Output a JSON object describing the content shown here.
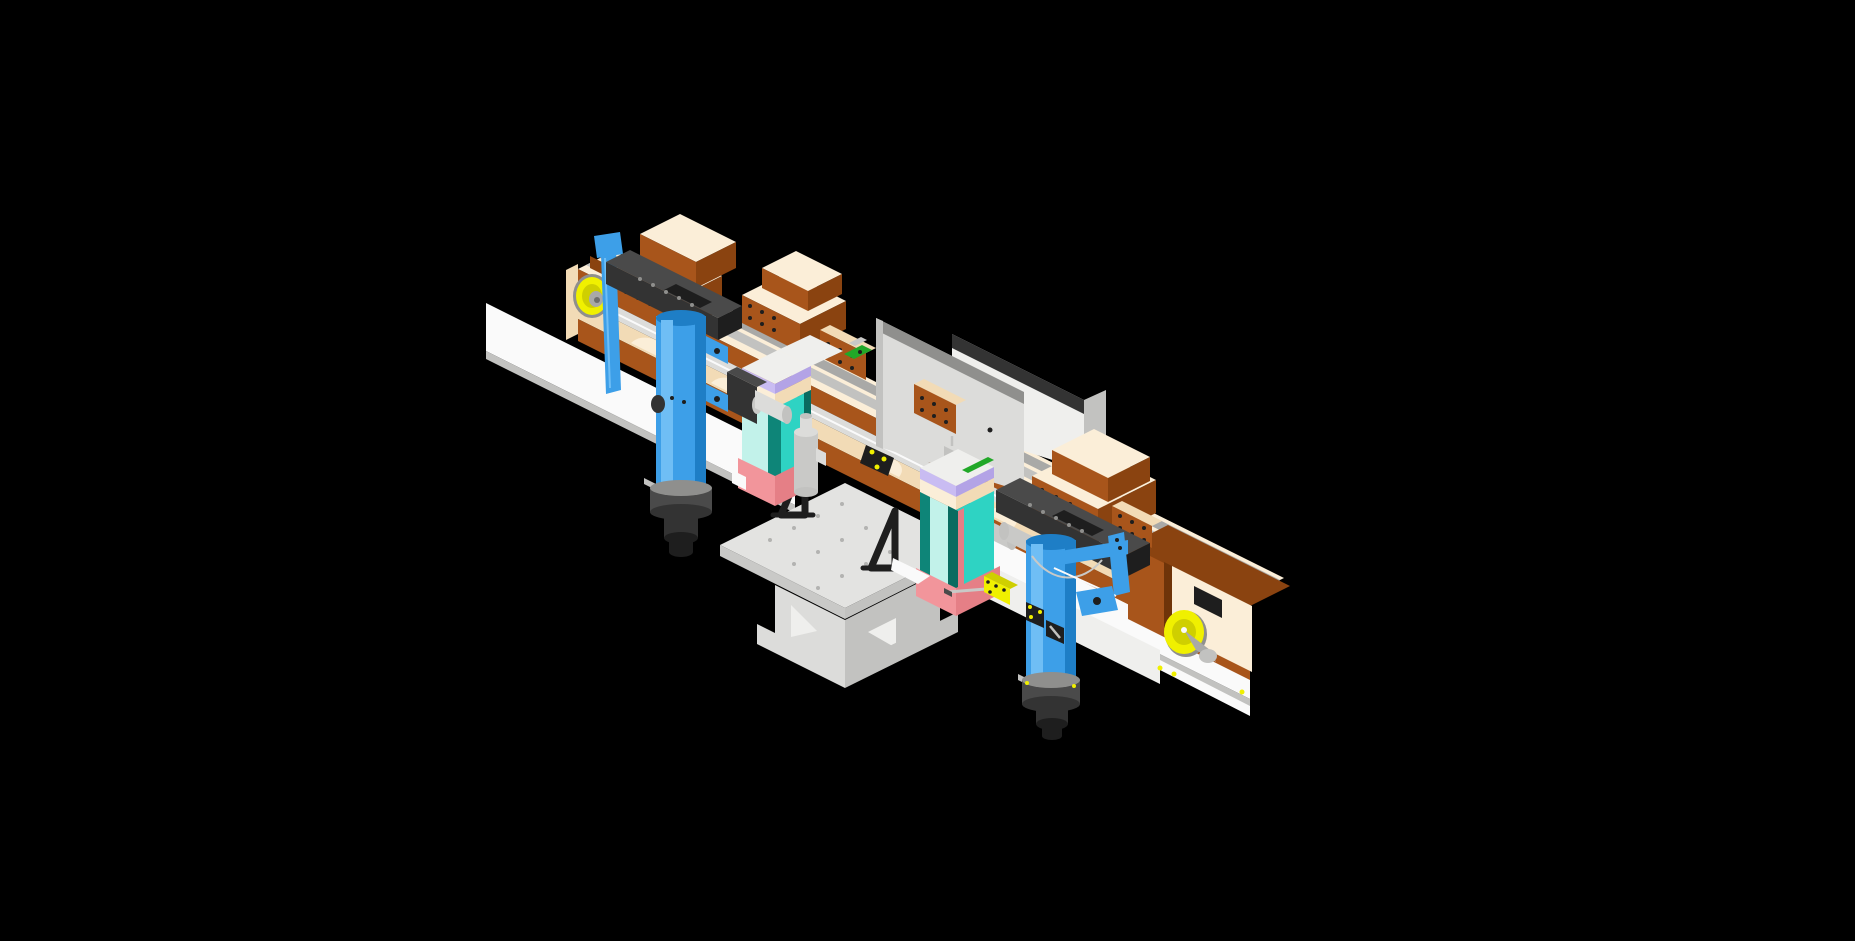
{
  "meta": {
    "description": "Isometric 3D CAD render of an automated dual-conveyor assembly machine floating on a black viewport background",
    "view": "isometric",
    "background": "#000000"
  },
  "colors": {
    "background": "#000000",
    "brown": "#A8551B",
    "brownDark": "#8A4310",
    "brownDarker": "#6F3409",
    "creamTop": "#FBEED8",
    "creamSide": "#F2DBB6",
    "creamDark": "#E6C99E",
    "white": "#FAFAFA",
    "whiteDim": "#EFEFED",
    "grayLight": "#DCDCDA",
    "gray": "#C2C2C0",
    "grayMid": "#A9A9A7",
    "grayDark": "#6E6E6C",
    "steel": "#8F8F8D",
    "silver": "#C9C9C7",
    "slate": "#4A4A4A",
    "slateDark": "#333333",
    "nearBlack": "#1E1E1E",
    "blue": "#3D9FE8",
    "blueLight": "#6FBEF5",
    "blueDark": "#1E7EC6",
    "teal": "#2ED3C3",
    "tealPale": "#C2F2EA",
    "tealDark": "#0E8578",
    "tealDeep": "#0A6B60",
    "pink": "#F2959B",
    "pinkDark": "#E57F86",
    "lavender": "#C9BCF2",
    "lavenderDark": "#B3A3E6",
    "yellow": "#F0F000",
    "yellowDark": "#CFCF00",
    "green": "#21A828",
    "tableTop": "#E3E3E1",
    "tableSide": "#C9C9C7",
    "tableDark": "#B3B3B1"
  },
  "parts": [
    {
      "name": "left-conveyor",
      "label": "Left conveyor rail module",
      "color_key": "brown"
    },
    {
      "name": "right-conveyor",
      "label": "Right conveyor rail module",
      "color_key": "brown"
    },
    {
      "name": "left-idler-pulley",
      "label": "Left yellow idler pulley",
      "color_key": "yellow"
    },
    {
      "name": "right-idler-pulley",
      "label": "Right yellow idler pulley",
      "color_key": "yellow"
    },
    {
      "name": "feed-hopper-1",
      "label": "Feed hopper block 1",
      "color_key": "brown"
    },
    {
      "name": "feed-hopper-2",
      "label": "Feed hopper block 2",
      "color_key": "brown"
    },
    {
      "name": "junction-box-1",
      "label": "Junction block with bolt holes",
      "color_key": "brown"
    },
    {
      "name": "junction-box-2",
      "label": "Junction block with bolt holes",
      "color_key": "brown"
    },
    {
      "name": "discharge-hopper",
      "label": "Large discharge hopper",
      "color_key": "brown"
    },
    {
      "name": "back-panel-1",
      "label": "Gray backdrop panel",
      "color_key": "grayLight"
    },
    {
      "name": "back-panel-2",
      "label": "White backdrop panel with dark cap",
      "color_key": "whiteDim"
    },
    {
      "name": "center-table",
      "label": "Perforated breadboard table on pedestal",
      "color_key": "tableTop"
    },
    {
      "name": "angle-bracket-1",
      "label": "Black triangular angle bracket",
      "color_key": "nearBlack"
    },
    {
      "name": "angle-bracket-2",
      "label": "Black triangular angle bracket",
      "color_key": "nearBlack"
    },
    {
      "name": "pick-unit-1",
      "label": "Teal vertical pick-and-place carriage",
      "color_key": "teal"
    },
    {
      "name": "pick-unit-2",
      "label": "Teal vertical pick-and-place carriage",
      "color_key": "teal"
    },
    {
      "name": "air-cylinder-1",
      "label": "Blue pneumatic cylinder with slider arm",
      "color_key": "blue"
    },
    {
      "name": "air-cylinder-2",
      "label": "Blue pneumatic cylinder with slider arm",
      "color_key": "blue"
    },
    {
      "name": "drive-motor-1",
      "label": "Drive motor with coupling",
      "color_key": "slateDark"
    },
    {
      "name": "drive-motor-2",
      "label": "Drive motor with coupling",
      "color_key": "slateDark"
    },
    {
      "name": "regulator",
      "label": "Filter-regulator cylinder on table",
      "color_key": "silver"
    },
    {
      "name": "yellow-bracket",
      "label": "Yellow L-mounting bracket",
      "color_key": "yellow"
    },
    {
      "name": "rail-clamp",
      "label": "Black rail clamp with yellow bolts",
      "color_key": "nearBlack"
    },
    {
      "name": "sensor-green",
      "label": "Green sensor clips",
      "color_key": "green"
    }
  ]
}
